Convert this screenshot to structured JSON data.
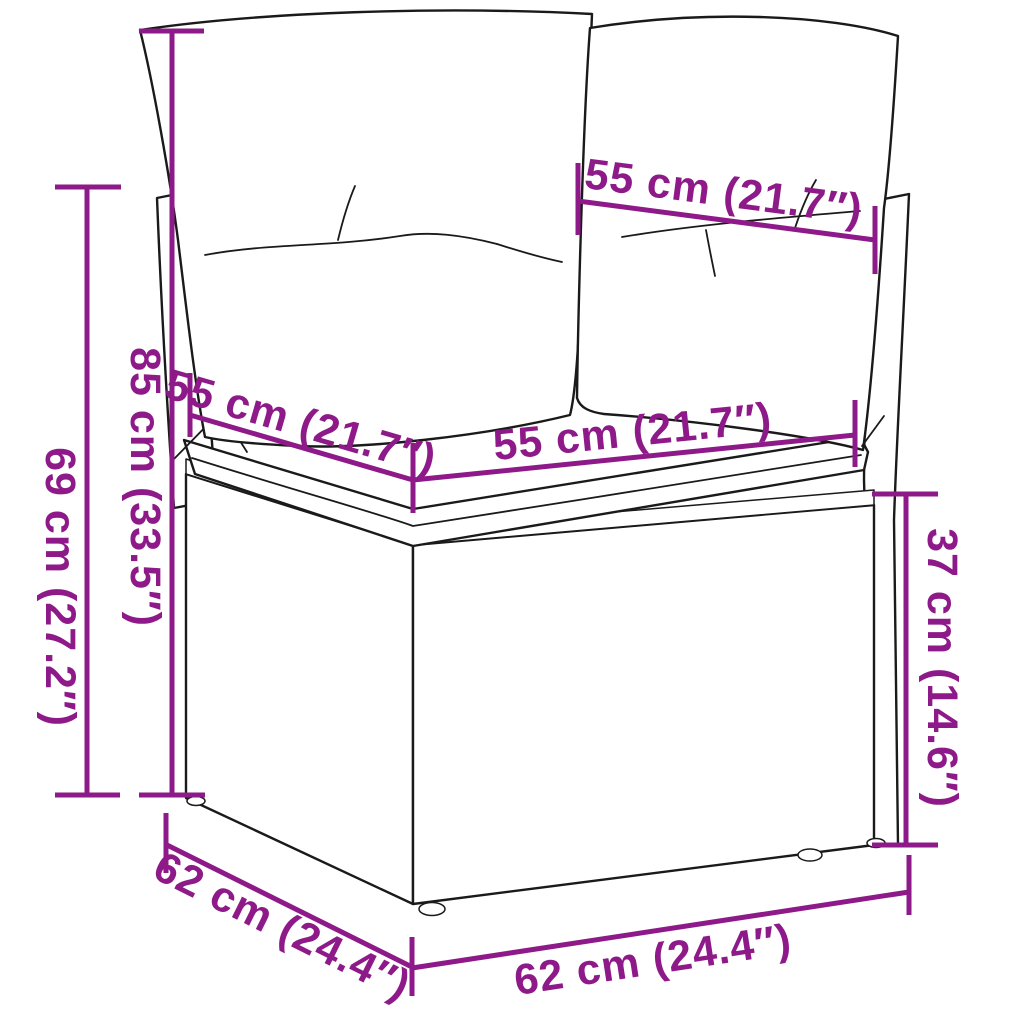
{
  "colors": {
    "dimension_accent": "#8E1A89",
    "line_art": "#1A1A1A",
    "background": "#FFFFFF"
  },
  "diagram": {
    "subject": "corner rattan garden sofa module with two back cushions and seat cushion",
    "style": "black outline line art with magenta dimension annotations"
  },
  "dimensions": {
    "top_back": "55 cm (21.7″)",
    "left_outer_height": "69 cm (27.2″)",
    "left_inner_height": "85 cm (33.5″)",
    "seat_depth_left": "55 cm (21.7″)",
    "seat_width_front": "55 cm (21.7″)",
    "right_base_height": "37 cm (14.6″)",
    "bottom_left_depth": "62 cm (24.4″)",
    "bottom_front_width": "62 cm (24.4″)"
  }
}
